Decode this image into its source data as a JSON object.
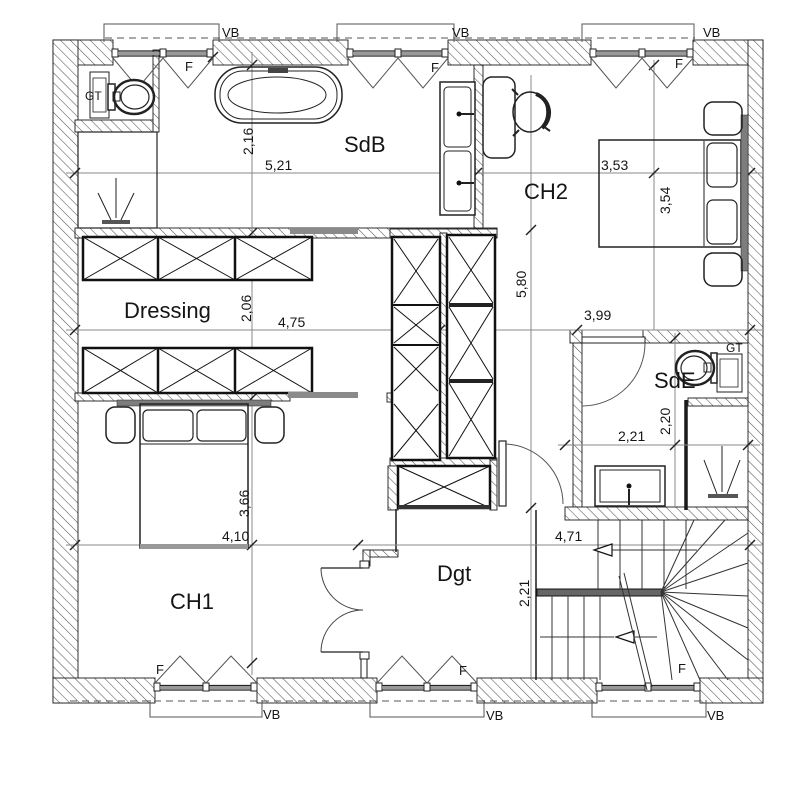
{
  "drawing": {
    "title": "floor-plan",
    "rooms": {
      "sdb": "SdB",
      "ch2": "CH2",
      "dressing": "Dressing",
      "sde": "SdE",
      "ch1": "CH1",
      "dgt": "Dgt"
    },
    "dimensions": {
      "sdb_height": "2,16",
      "sdb_width": "5,21",
      "ch2_width": "3,53",
      "ch2_height": "3,54",
      "center_height": "5,80",
      "dressing_height": "2,06",
      "dressing_width": "4,75",
      "landing_width": "3,99",
      "sde_width": "2,21",
      "sde_height": "2,20",
      "ch1_height": "3,66",
      "ch1_width": "4,10",
      "dgt_width": "4,71",
      "dgt_height": "2,21"
    },
    "annotations": {
      "window": "F",
      "balcony": "VB",
      "duct": "GT"
    },
    "colors": {
      "line": "#1a1a1a",
      "dim_line": "#888888",
      "furniture_gray": "#7d7d7d"
    }
  }
}
